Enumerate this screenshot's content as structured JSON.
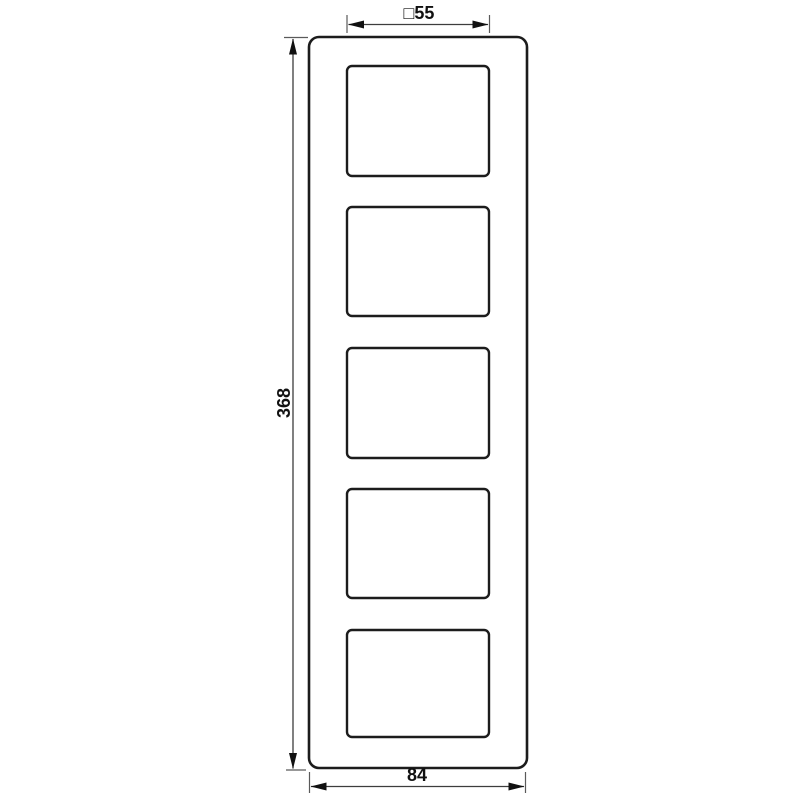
{
  "drawing": {
    "background_color": "#ffffff",
    "outline_color": "#1c1c1c",
    "dimension_line_color": "#3d3d3d",
    "text_color": "#111111",
    "frame": {
      "cutout_count": 5
    },
    "dimensions": {
      "cutout_width_label": "□55",
      "height_label": "368",
      "width_label": "84"
    }
  }
}
